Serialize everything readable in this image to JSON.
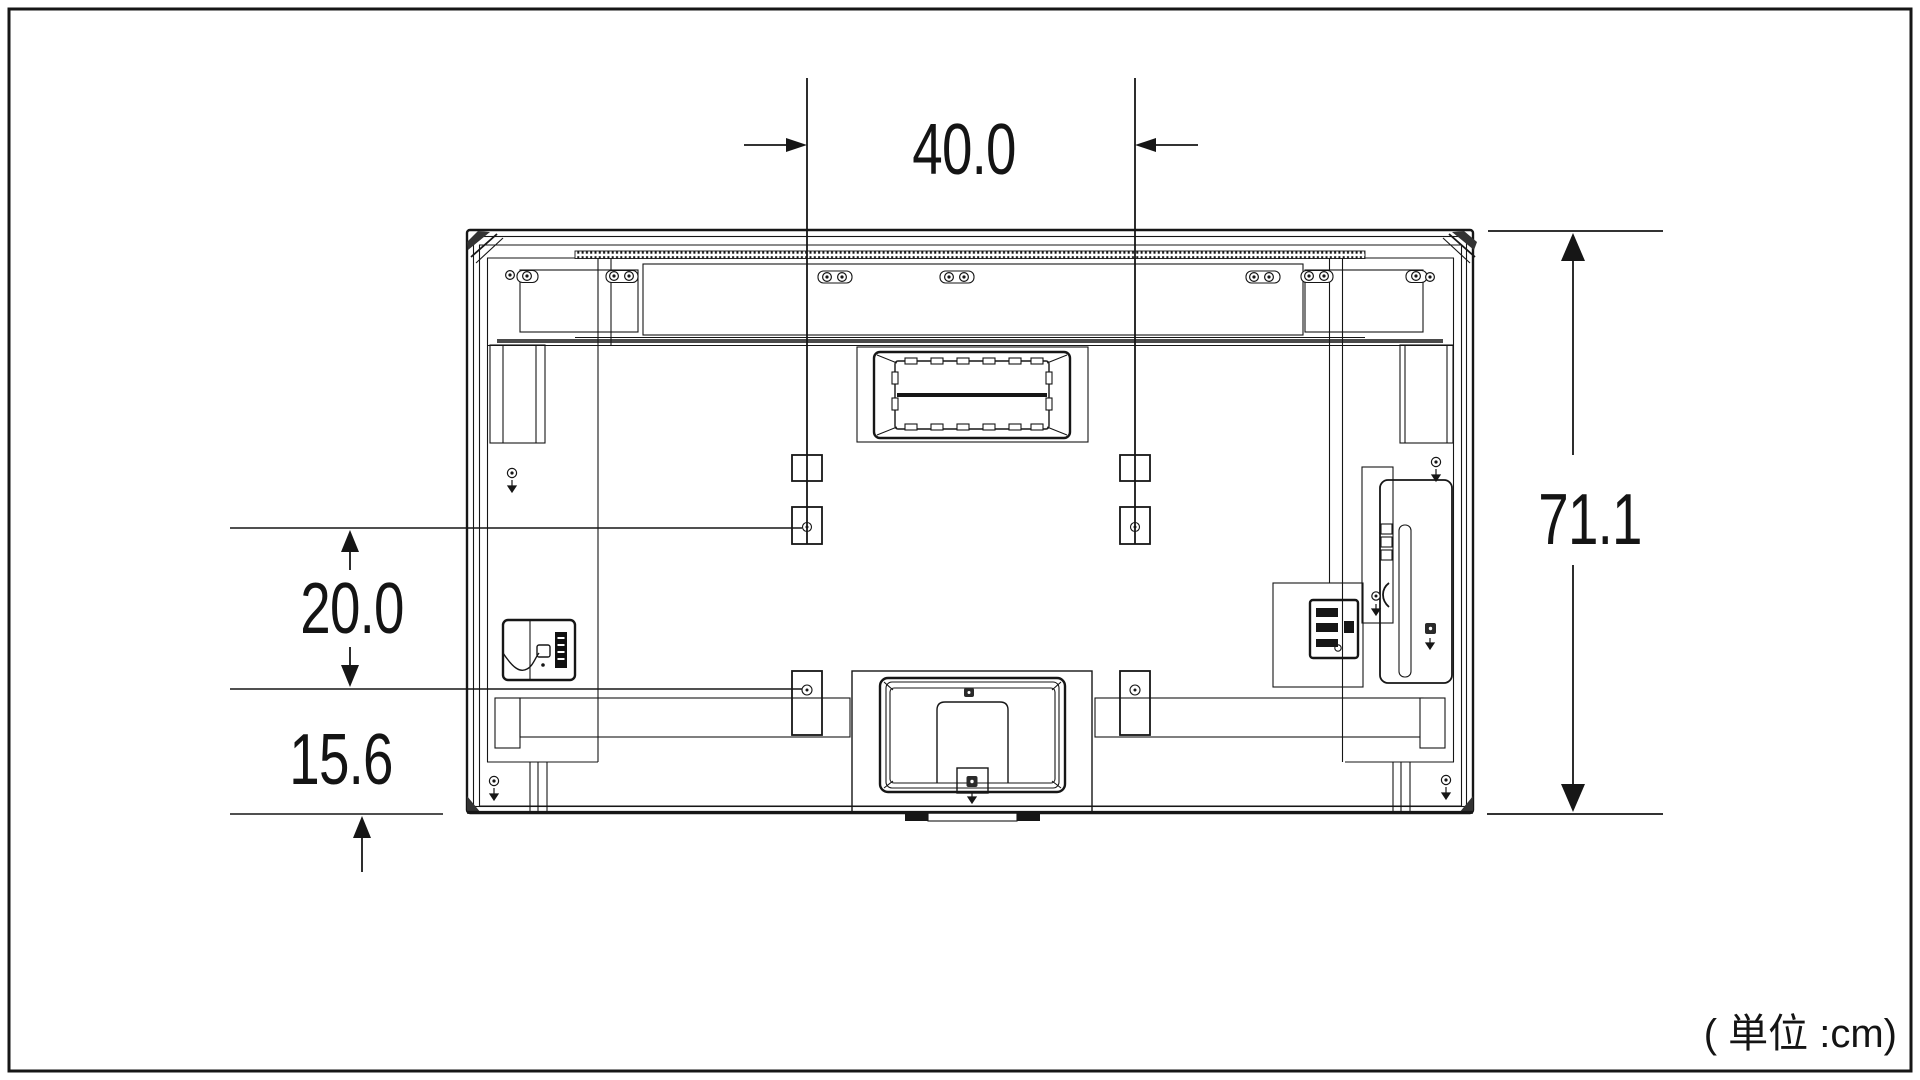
{
  "diagram": {
    "unit_note": "( 単位 :cm)",
    "dimensions": {
      "mount_hole_spacing_horizontal_cm": "40.0",
      "set_height_cm": "71.1",
      "hole_row_vertical_spacing_cm": "20.0",
      "lower_hole_to_bottom_cm": "15.6"
    },
    "colors": {
      "line": "#161616",
      "background": "#ffffff"
    }
  }
}
